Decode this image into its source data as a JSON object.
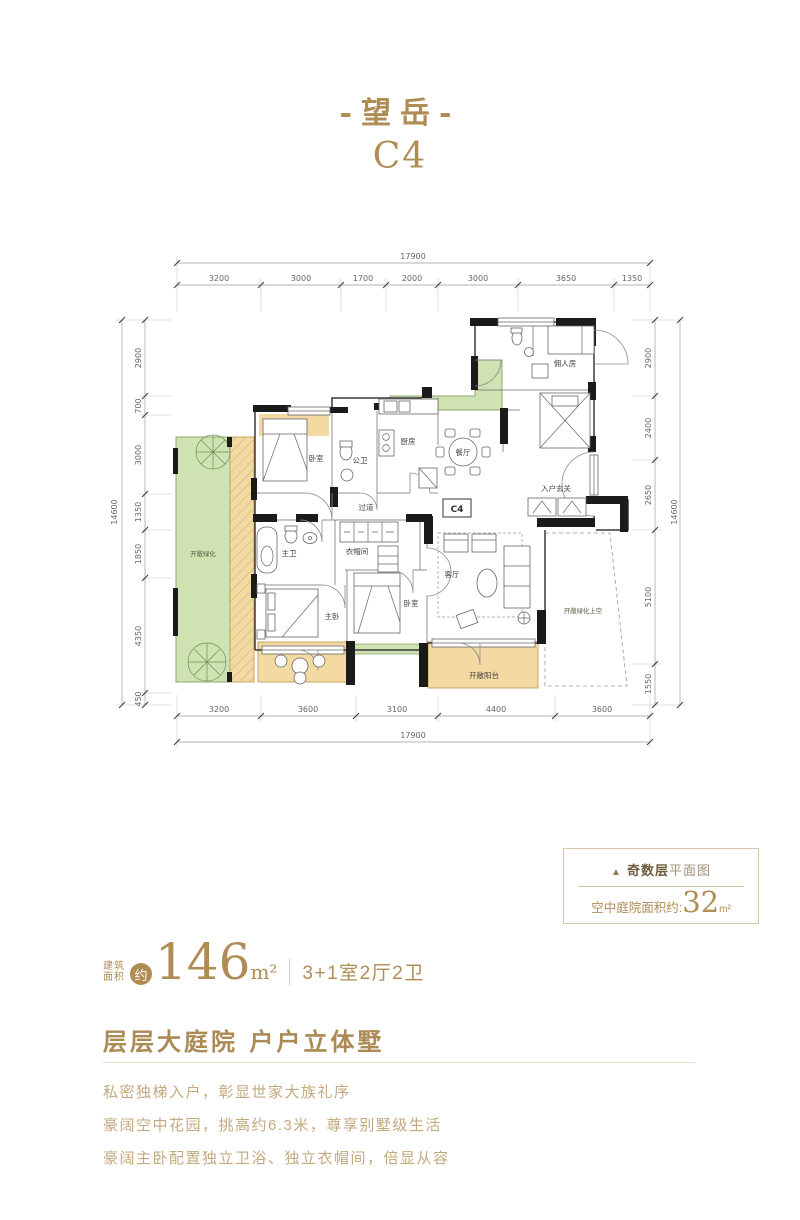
{
  "title": {
    "main": "-望岳-",
    "code": "C4"
  },
  "plan": {
    "unit_label": "C4",
    "dims": {
      "top": {
        "overall": "17900",
        "segments": [
          "3200",
          "3000",
          "1700",
          "2000",
          "3000",
          "3650",
          "1350"
        ]
      },
      "bottom": {
        "overall": "17900",
        "segments": [
          "3200",
          "3600",
          "3100",
          "4400",
          "3600"
        ]
      },
      "left": {
        "overall": "14600",
        "segments": [
          "2900",
          "700",
          "3000",
          "1350",
          "1850",
          "4350",
          "450"
        ]
      },
      "right": {
        "overall": "14600",
        "segments": [
          "2900",
          "2400",
          "2650",
          "5100",
          "1550"
        ]
      }
    },
    "rooms": [
      {
        "label": "开敞绿化"
      },
      {
        "label": "卧室"
      },
      {
        "label": "公卫"
      },
      {
        "label": "厨房"
      },
      {
        "label": "餐厅"
      },
      {
        "label": "佣人房"
      },
      {
        "label": "入户玄关"
      },
      {
        "label": "过道"
      },
      {
        "label": "主卫"
      },
      {
        "label": "衣帽间"
      },
      {
        "label": "主卧"
      },
      {
        "label": "卧室"
      },
      {
        "label": "客厅"
      },
      {
        "label": "开敞绿化上空"
      },
      {
        "label": "开敞阳台"
      }
    ]
  },
  "info_box": {
    "marker": "▲",
    "floor_type": "奇数层",
    "plan_suffix": "平面图",
    "courtyard_label": "空中庭院面积约:",
    "courtyard_value": "32",
    "courtyard_unit": "m²"
  },
  "area": {
    "label_line1": "建筑",
    "label_line2": "面积",
    "approx_badge": "约",
    "value": "146",
    "unit": "m²",
    "layout": "3+1室2厅2卫"
  },
  "tagline": {
    "heading": "层层大庭院  户户立体墅",
    "lines": [
      "私密独梯入户，彰显世家大族礼序",
      "豪阔空中花园，挑高约6.3米，尊享别墅级生活",
      "豪阔主卧配置独立卫浴、独立衣帽间，倍显从容"
    ]
  },
  "colors": {
    "gold": "#b08c55",
    "light_gold": "#c3a97e",
    "green": "#cfe2b2",
    "tan": "#f3d9a2",
    "wall": "#1b1b1b"
  }
}
